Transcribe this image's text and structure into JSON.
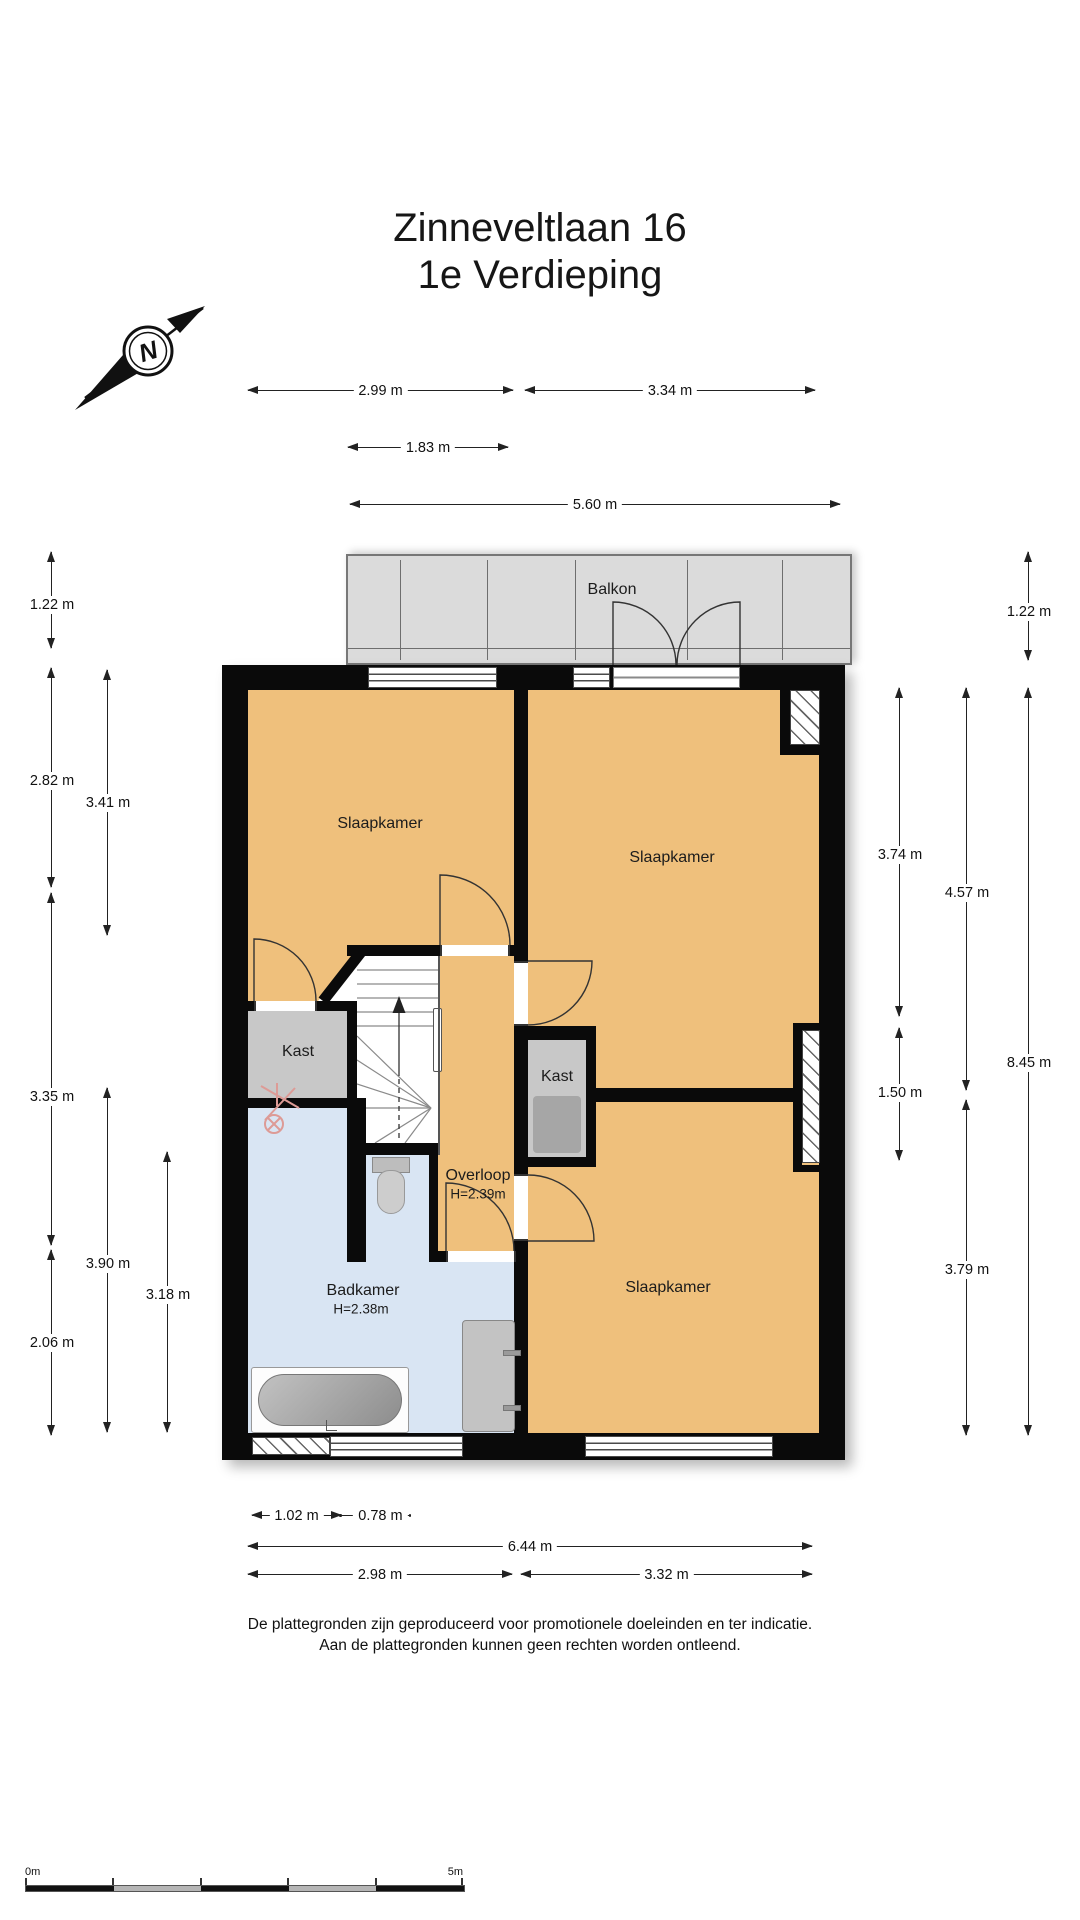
{
  "title": {
    "line1": "Zinneveltlaan 16",
    "line2": "1e Verdieping"
  },
  "compass": {
    "north_label": "N"
  },
  "plan": {
    "balcony_label": "Balkon",
    "rooms": [
      {
        "id": "slaapkamer-links",
        "label": "Slaapkamer"
      },
      {
        "id": "slaapkamer-rechtsboven",
        "label": "Slaapkamer"
      },
      {
        "id": "slaapkamer-rechtsonder",
        "label": "Slaapkamer"
      },
      {
        "id": "badkamer",
        "label": "Badkamer",
        "height_label": "H=2.38m"
      },
      {
        "id": "overloop",
        "label": "Overloop",
        "height_label": "H=2.39m"
      },
      {
        "id": "kast-links",
        "label": "Kast"
      },
      {
        "id": "kast-rechts",
        "label": "Kast"
      }
    ]
  },
  "dimensions": {
    "top": [
      "2.99 m",
      "3.34 m",
      "1.83 m",
      "5.60 m"
    ],
    "left": [
      "1.22 m",
      "2.82 m",
      "3.35 m",
      "2.06 m",
      "3.41 m",
      "3.90 m",
      "3.18 m"
    ],
    "right": [
      "3.74 m",
      "1.50 m",
      "4.57 m",
      "3.79 m",
      "1.22 m",
      "8.45 m"
    ],
    "bottom": [
      "1.02 m",
      "0.78 m",
      "6.44 m",
      "2.98 m",
      "3.32 m"
    ]
  },
  "footer": {
    "line1": "De plattegronden zijn geproduceerd voor promotionele doeleinden en ter indicatie.",
    "line2": "Aan de plattegronden kunnen geen rechten worden ontleend."
  },
  "scale_bar": {
    "start_label": "0m",
    "end_label": "5m"
  },
  "colors": {
    "room_orange": "#EFC07C",
    "bathroom_blue": "#D9E5F3",
    "balcony_gray": "#DBDBDB",
    "closet_gray": "#C8C8C8",
    "closet_dark": "#A6A6A6",
    "wall_black": "#0A0A0A"
  }
}
